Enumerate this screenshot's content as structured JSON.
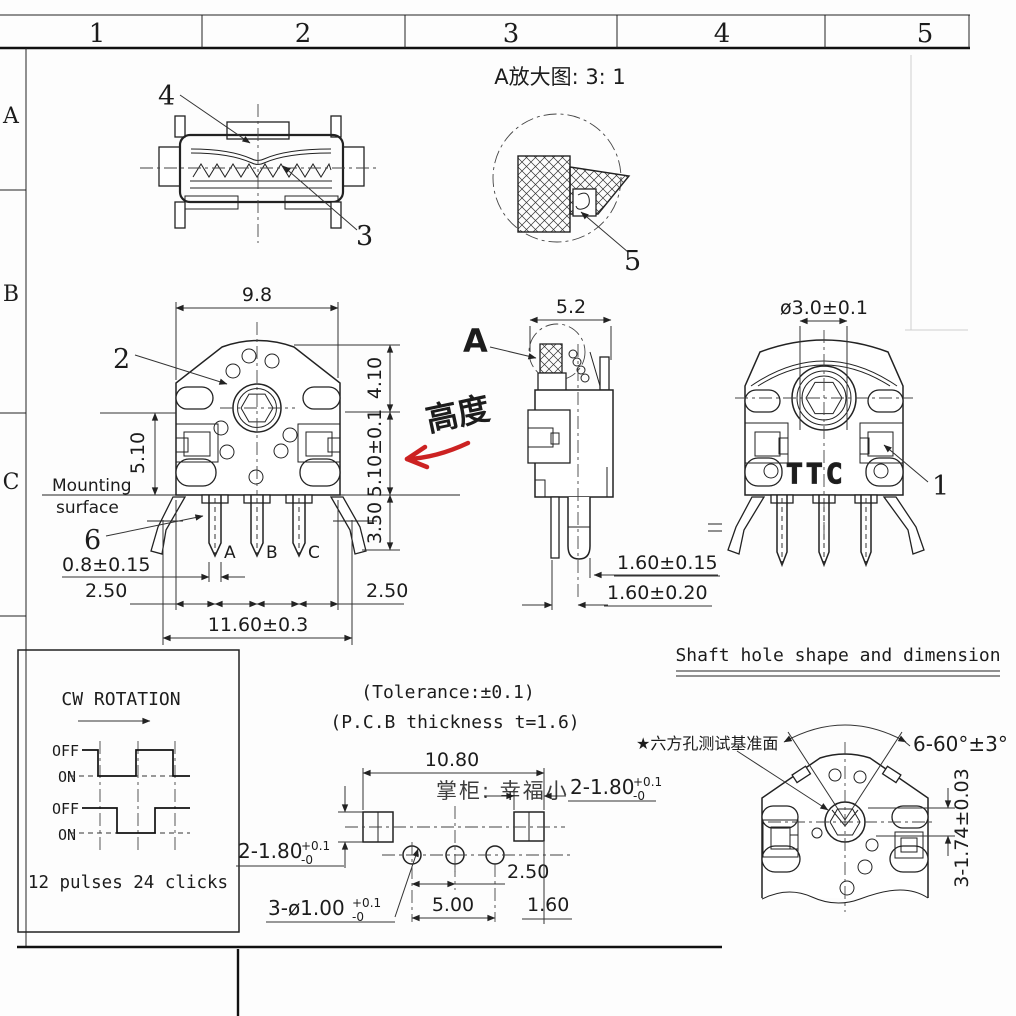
{
  "frame": {
    "columns": [
      "1",
      "2",
      "3",
      "4",
      "5"
    ],
    "rows": [
      "A",
      "B",
      "C"
    ]
  },
  "callouts": {
    "c1": "1",
    "c2": "2",
    "c3": "3",
    "c4": "4",
    "c5": "5",
    "c6": "6"
  },
  "detail_view": {
    "title": "A放大图: 3: 1"
  },
  "front_view": {
    "dim_top_width": "9.8",
    "dim_h1": "4.10",
    "dim_h2": "5.10±0.1",
    "dim_h3": "3.50",
    "dim_left_h": "5.10",
    "dim_pin_w": "0.8±0.15",
    "dim_left_pitch": "2.50",
    "dim_right_pitch": "2.50",
    "dim_overall": "11.60±0.3",
    "mounting1": "Mounting",
    "mounting2": "surface",
    "pins": [
      "A",
      "B",
      "C"
    ]
  },
  "height_annotation": {
    "text": "高度",
    "color": "#cc2222"
  },
  "side_view": {
    "dim_width": "5.2",
    "detail_label": "A",
    "dim_tip": "1.60±0.15",
    "dim_leg": "1.60±0.20"
  },
  "rear_view": {
    "dim_shaft": "ø3.0±0.1",
    "logo": "TTC"
  },
  "shaft_hole_section": {
    "heading": "Shaft hole shape and dimension",
    "datum_note": "★六方孔测试基准面",
    "dim_angle": "6-60°±3°",
    "dim_flats": "3-1.74±0.03"
  },
  "waveform": {
    "title": "CW ROTATION",
    "off_label": "OFF",
    "on_label": "ON",
    "caption": "12 pulses 24 clicks"
  },
  "notes": {
    "tolerance": "(Tolerance:±0.1)",
    "pcb_thickness": "(P.C.B thickness t=1.6)"
  },
  "pcb_view": {
    "dim_width": "10.80",
    "pad_dim": "2-1.80",
    "hole_dim": "3-ø1.00",
    "tol_plus": "+0.1",
    "tol_minus": "-0",
    "dim_pitch": "2.50",
    "dim_span": "5.00",
    "dim_offset": "1.60"
  },
  "watermark": {
    "text": "掌柜: 幸福小",
    "color": "#f2a2a8"
  }
}
